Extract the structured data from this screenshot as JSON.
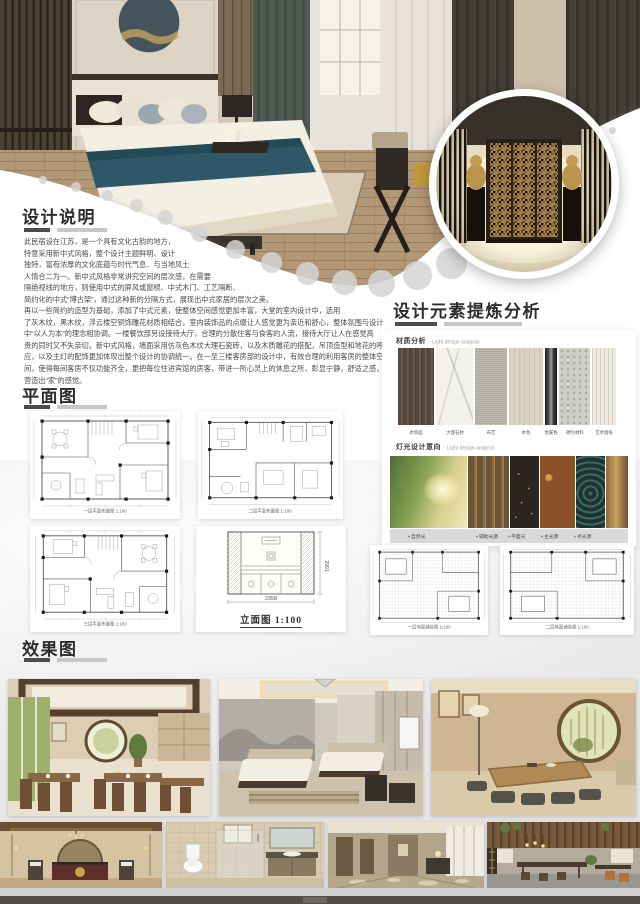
{
  "description": {
    "title": "设计说明",
    "lines": [
      "此民宿设在江苏，是一个具有文化古韵的地方，",
      "特意采用新中式风格，整个设计主题鲜明、设计",
      "独特，富有浓厚的文化底蕴与时代气息、与当地风土",
      "人情合二为一。新中式风格非常讲究空间的层次感，在需要",
      "隔绝视线的地方，则使用中式的屏风或窗棂、中式木门、工艺隔断、",
      "简约化的中式“博古架”，通过这种新的分隔方式，展现出中式家居的层次之美。",
      "再以一些简约的造型为基础，添加了中式元素，使整体空间感觉更加丰富，大堂的室内设计中，选用",
      "了灰木纹，黑木纹，浮云楼空铜饰雕花材质相结合，室内装饰品的点缀让人感觉更为亲近和舒心，整体氛围与设计",
      "中“以人为本”的理念相协调。一楼餐饮部另设接待大厅，合理的分散住客与食客的人流，接待大厅让人在感觉高",
      "贵的同时又不失亲切。新中式风格，墙面采用仿灰色木纹大理石瓷砖，以及木质雕花的搭配，吊顶造型和地花的呼",
      "应，以及主灯的配饰更加体现出整个设计的协调统一。在一至三楼客房部的设计中，有效合理的利用客房的整体空",
      "间，使得每间客房不仅功能齐全，更把每位住进宾馆的房客，带进一所心灵上的休息之所，彰显宁静，舒适之感，",
      "营造出“家”的感觉。"
    ]
  },
  "analysis": {
    "title": "设计元素提炼分析",
    "material": {
      "label": "材质分析",
      "sublabel": "· Light design analysis",
      "swatches": [
        {
          "name": "木饰面",
          "color": "#55483e"
        },
        {
          "name": "大理石材",
          "color": "#f3f1ed"
        },
        {
          "name": "布艺",
          "color": "#b7b3aa"
        },
        {
          "name": "木色",
          "color": "#dbd3c1"
        },
        {
          "name": "金属色",
          "color": "#3a3a3a"
        },
        {
          "name": "硬包材料",
          "color": "#d0cec8"
        },
        {
          "name": "艺术墙纸",
          "color": "#eceae2"
        }
      ]
    },
    "lighting": {
      "label": "灯光设计意向",
      "sublabel": "· Light design analysis",
      "captions": [
        "自然光",
        "辅助光源",
        "平面光",
        "主光源",
        "点光源"
      ]
    }
  },
  "floor_plan": {
    "title": "平面图",
    "captions": {
      "plan1": "一层平面布置图 1:100",
      "plan2": "二层平面布置图 1:100",
      "plan3": "三层平面布置图 1:100",
      "elevation": "立面图 1:100",
      "paving1": "一层地面铺装图 1:100",
      "paving2": "二层地面铺装图 1:100"
    },
    "elevation_dims": {
      "width": "2358",
      "height": "2991"
    }
  },
  "effects": {
    "title": "效果图"
  },
  "colors": {
    "accent_dark": "#4c4c4c",
    "accent_light": "#c7c7c7",
    "footer": "#534e48",
    "bed_runner_teal": "#2e5868"
  }
}
